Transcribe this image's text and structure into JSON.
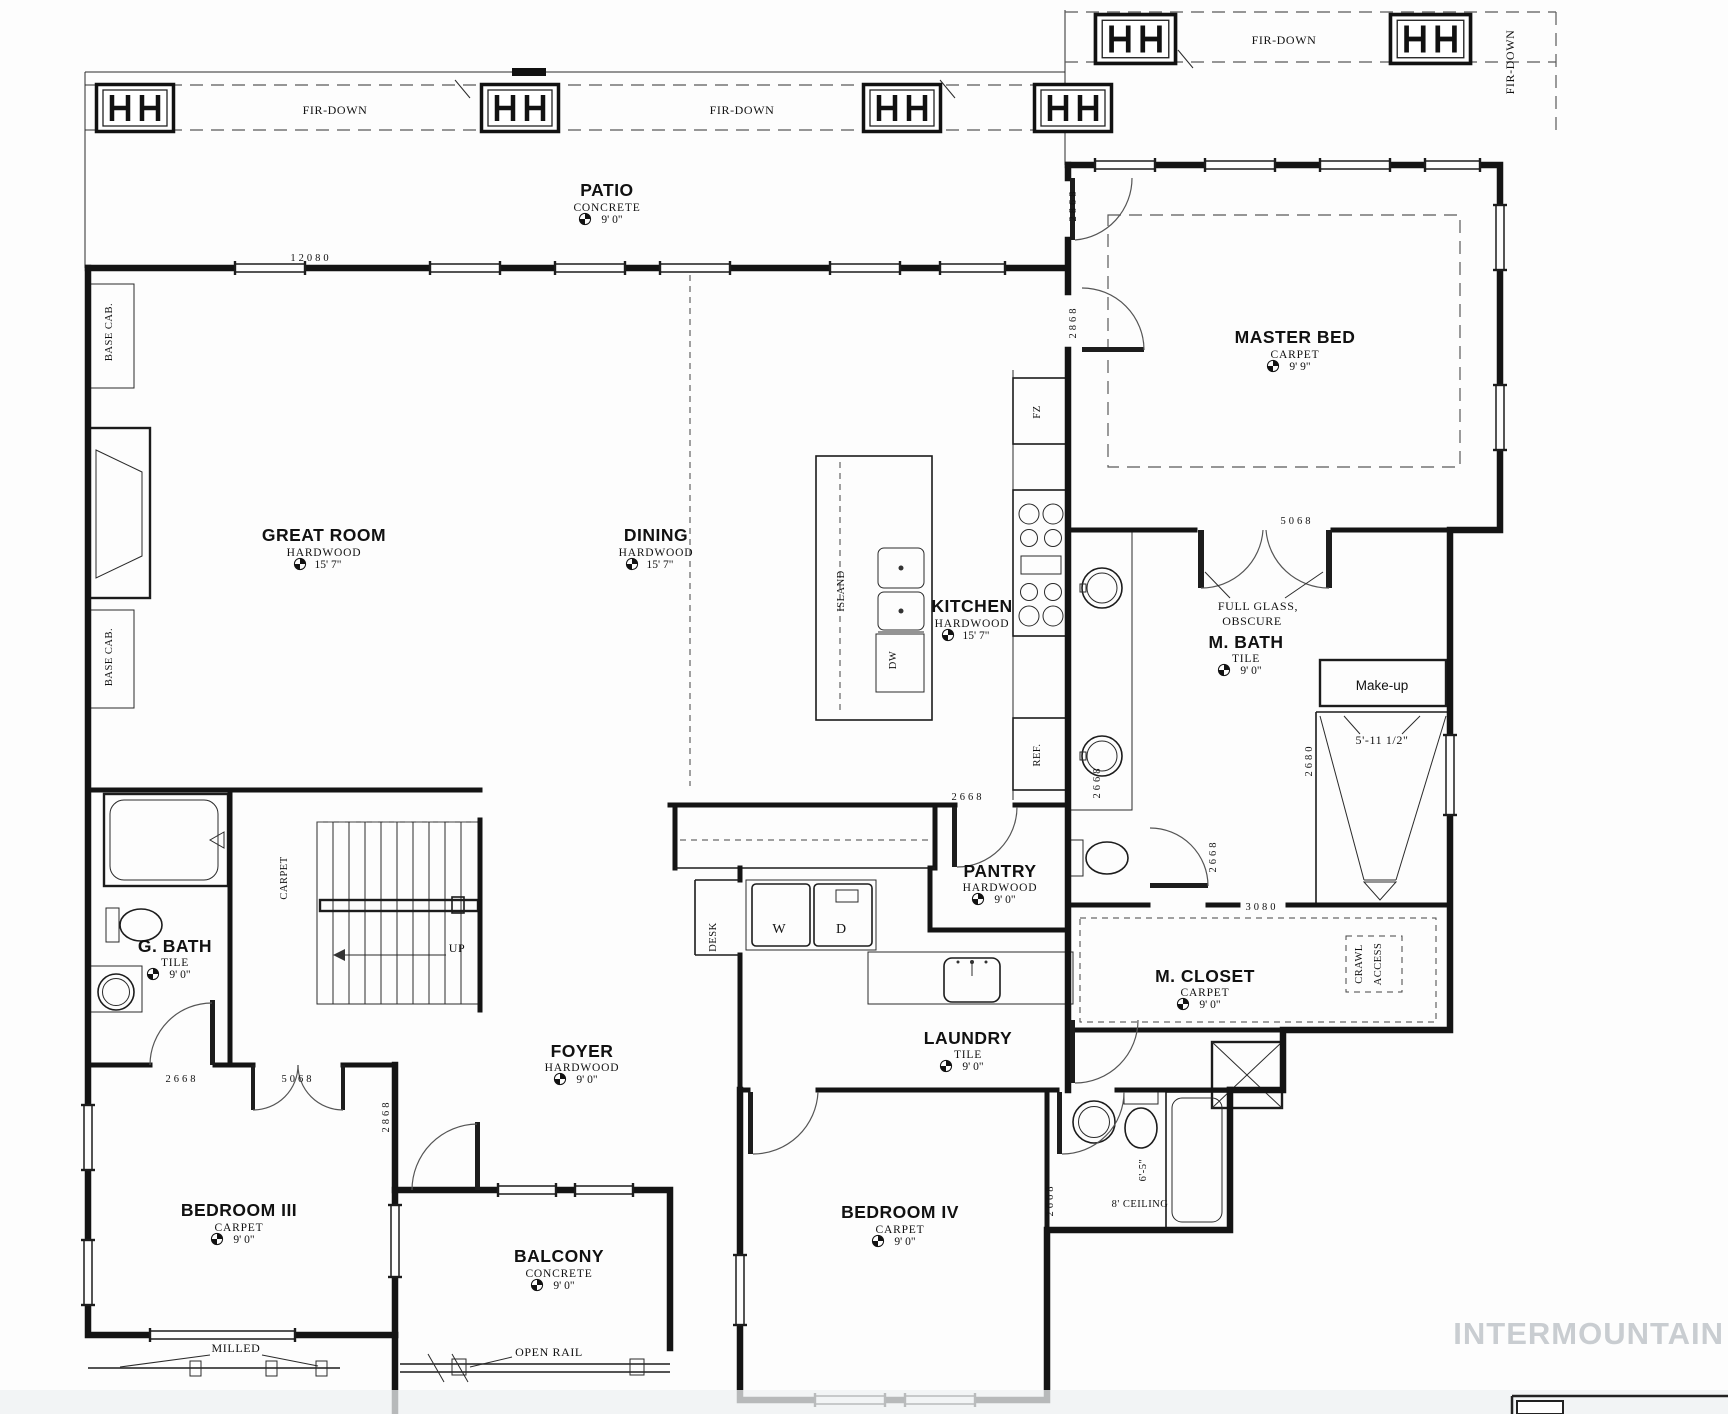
{
  "watermark": "INTERMOUNTAIN",
  "rooms": {
    "patio": {
      "name": "PATIO",
      "material": "CONCRETE",
      "height": "9' 0\""
    },
    "master_bed": {
      "name": "MASTER BED",
      "material": "CARPET",
      "height": "9' 9\""
    },
    "great_room": {
      "name": "GREAT ROOM",
      "material": "HARDWOOD",
      "height": "15' 7\""
    },
    "dining": {
      "name": "DINING",
      "material": "HARDWOOD",
      "height": "15' 7\""
    },
    "kitchen": {
      "name": "KITCHEN",
      "material": "HARDWOOD",
      "height": "15' 7\""
    },
    "m_bath": {
      "name": "M. BATH",
      "material": "TILE",
      "height": "9' 0\""
    },
    "g_bath": {
      "name": "G. BATH",
      "material": "TILE",
      "height": "9' 0\""
    },
    "pantry": {
      "name": "PANTRY",
      "material": "HARDWOOD",
      "height": "9' 0\""
    },
    "m_closet": {
      "name": "M. CLOSET",
      "material": "CARPET",
      "height": "9' 0\""
    },
    "foyer": {
      "name": "FOYER",
      "material": "HARDWOOD",
      "height": "9' 0\""
    },
    "laundry": {
      "name": "LAUNDRY",
      "material": "TILE",
      "height": "9' 0\""
    },
    "bedroom_3": {
      "name": "BEDROOM III",
      "material": "CARPET",
      "height": "9' 0\""
    },
    "bedroom_4": {
      "name": "BEDROOM IV",
      "material": "CARPET",
      "height": "9' 0\""
    },
    "balcony": {
      "name": "BALCONY",
      "material": "CONCRETE",
      "height": "9' 0\""
    }
  },
  "annotations": {
    "fir_down": "FIR-DOWN",
    "full_glass_line1": "FULL GLASS,",
    "full_glass_line2": "OBSCURE",
    "make_up": "Make-up",
    "base_cab": "BASE CAB.",
    "island": "ISLAND",
    "dishwasher": "DW",
    "freezer": "FZ",
    "refrigerator": "REF.",
    "desk": "DESK",
    "washer": "W",
    "dryer": "D",
    "stairs_carpet": "CARPET",
    "up": "UP",
    "crawl_line1": "CRAWL",
    "crawl_line2": "ACCESS",
    "ceiling_8ft": "8' CEILING",
    "milled": "MILLED",
    "open_rail": "OPEN RAIL"
  },
  "dimensions": {
    "d12080": "12080",
    "d2868": "2868",
    "d2668": "2668",
    "d5068": "5068",
    "d3080": "3080",
    "d2680": "2680",
    "d5_11_half": "5'-11 1/2\"",
    "d6_5": "6'-5\""
  }
}
